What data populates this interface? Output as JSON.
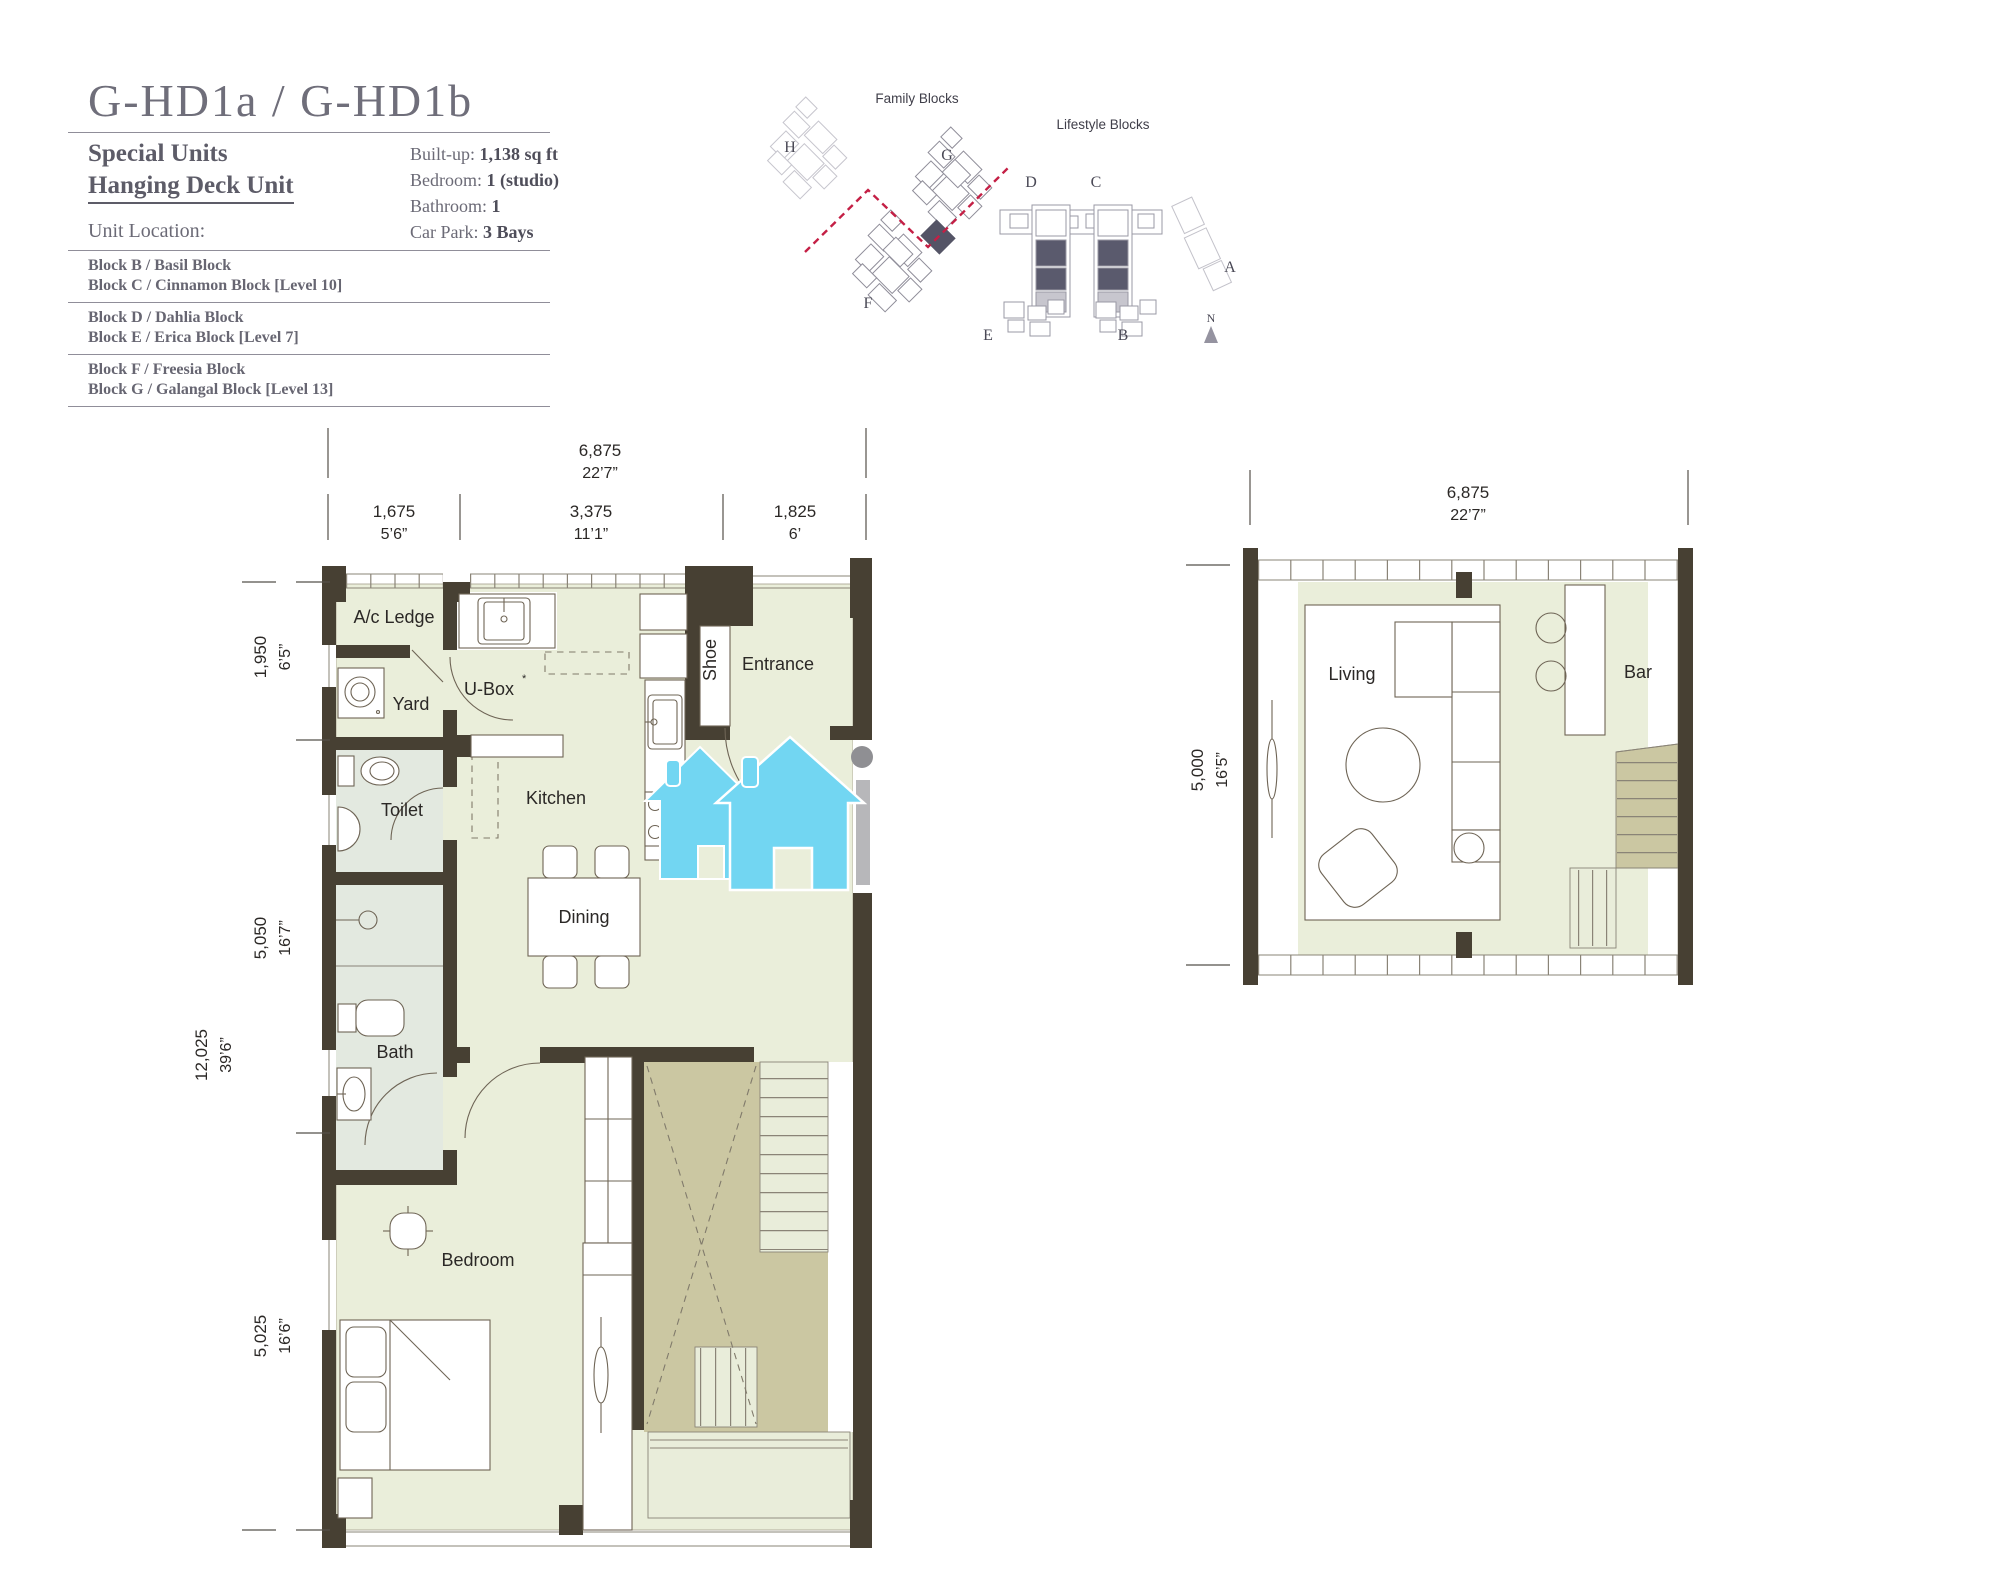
{
  "header": {
    "title": "G-HD1a / G-HD1b",
    "subtitle1": "Special Units",
    "subtitle2": "Hanging Deck Unit",
    "unit_location_label": "Unit Location:",
    "specs": [
      {
        "label": "Built-up: ",
        "value": "1,138 sq ft"
      },
      {
        "label": "Bedroom: ",
        "value": "1 (studio)"
      },
      {
        "label": "Bathroom: ",
        "value": "1"
      },
      {
        "label": "Car Park: ",
        "value": "3 Bays"
      }
    ],
    "block_groups": [
      {
        "line1": "Block B / Basil Block",
        "line2": "Block C / Cinnamon Block [Level 10]"
      },
      {
        "line1": "Block D / Dahlia Block",
        "line2": "Block E / Erica Block [Level 7]"
      },
      {
        "line1": "Block F / Freesia Block",
        "line2": "Block G / Galangal Block [Level 13]"
      }
    ]
  },
  "site_map": {
    "family_label": "Family Blocks",
    "lifestyle_label": "Lifestyle Blocks",
    "block_letters": [
      "H",
      "G",
      "D",
      "C",
      "F",
      "E",
      "B",
      "A"
    ],
    "compass_n": "N"
  },
  "main_plan": {
    "rooms": {
      "ac_ledge": "A/c Ledge",
      "yard": "Yard",
      "ubox": "U-Box",
      "ubox_mark": "*",
      "shoe": "Shoe",
      "entrance": "Entrance",
      "toilet": "Toilet",
      "kitchen": "Kitchen",
      "dining": "Dining",
      "bath": "Bath",
      "bedroom": "Bedroom"
    },
    "dims": {
      "overall_w_mm": "6,875",
      "overall_w_ft": "22’7”",
      "seg1_mm": "1,675",
      "seg1_ft": "5’6”",
      "seg2_mm": "3,375",
      "seg2_ft": "11’1”",
      "seg3_mm": "1,825",
      "seg3_ft": "6’",
      "left1_mm": "1,950",
      "left1_ft": "6’5”",
      "left2_mm": "5,050",
      "left2_ft": "16’7”",
      "left3_mm": "5,025",
      "left3_ft": "16’6”",
      "overall_h_mm": "12,025",
      "overall_h_ft": "39’6”"
    }
  },
  "deck_plan": {
    "rooms": {
      "living": "Living",
      "bar": "Bar"
    },
    "dims": {
      "w_mm": "6,875",
      "w_ft": "22’7”",
      "h_mm": "5,000",
      "h_ft": "16’5”"
    }
  },
  "colors": {
    "wall": "#474033",
    "floor": "#eaeeda",
    "wet_floor": "#e3e9e0",
    "stair_void": "#cbc7a2",
    "watermark_blue": "#72d6f2",
    "map_dashed_line": "#c41f45"
  }
}
